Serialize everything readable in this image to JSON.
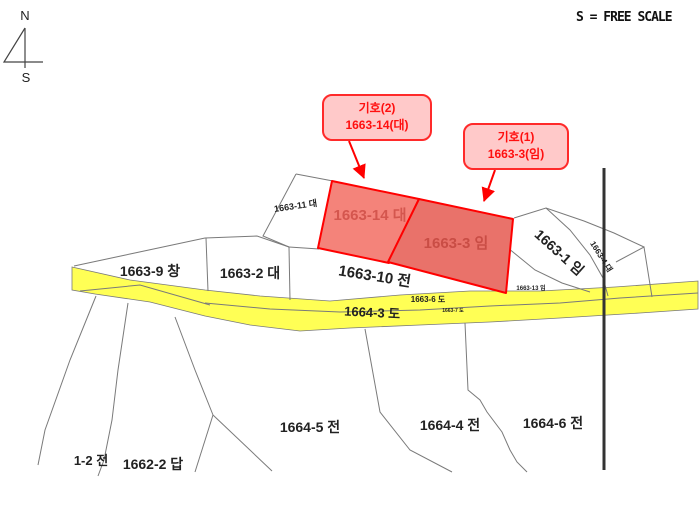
{
  "scale_note": "S = FREE SCALE",
  "compass": {
    "north": "N",
    "south": "S"
  },
  "callouts": [
    {
      "title": "기호(2)",
      "parcel": "1663-14(대)"
    },
    {
      "title": "기호(1)",
      "parcel": "1663-3(임)"
    }
  ],
  "highlighted_parcels": [
    {
      "label": "1663-14 대"
    },
    {
      "label": "1663-3 임"
    }
  ],
  "labels": {
    "l1663_11": "1663-11 대",
    "l1663_9": "1663-9 창",
    "l1663_2": "1663-2 대",
    "l1663_10": "1663-10 전",
    "l1663_1": "1663-1 임",
    "l1663_4": "1663-4 대",
    "l1663_13": "1663-13 임",
    "l1663_6": "1663-6 도",
    "l1663_7": "1663-7 도",
    "l1664_3": "1664-3 도",
    "l1664_5": "1664-5 전",
    "l1664_4": "1664-4 전",
    "l1664_6": "1664-6 전",
    "l1_2": "1-2 전",
    "l1662_2": "1662-2 답"
  },
  "colors": {
    "highlight_border": "#ff0000",
    "highlight_fill_left": "#f4837a",
    "highlight_fill_right": "#e9726a",
    "highlight_label_left": "#d4564e",
    "highlight_label_right": "#c94d45",
    "road_fill": "#ffff55",
    "callout_bg": "#ffc9c9",
    "callout_border": "#ff2a2a",
    "callout_text": "#ff0f0f",
    "boundary_line": "#7a7a7a",
    "map_text": "#222222",
    "thick_line": "#333333"
  }
}
